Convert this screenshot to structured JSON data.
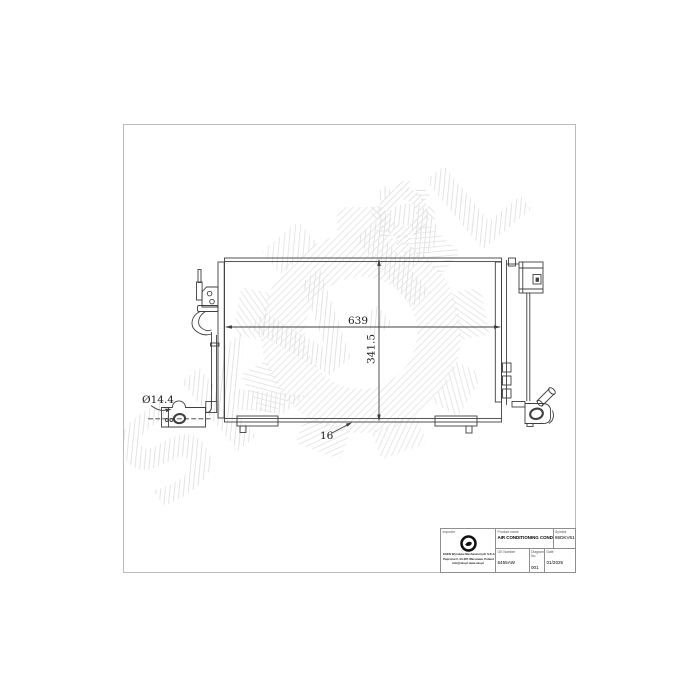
{
  "page": {
    "background": "#ffffff",
    "frame_border_color": "#bcbcbc",
    "line_color": "#3f3f3f"
  },
  "watermark": {
    "text": "SKV.PL",
    "hatch_color": "#e6e6e6"
  },
  "drawing": {
    "type": "technical-drawing",
    "subject": "air conditioning condenser outline with brackets, pipes and receiver drier",
    "dimensions": {
      "core_width": "639",
      "core_height": "341.5",
      "inlet_diameter": "Ø14.4",
      "thickness": "16"
    }
  },
  "title_block": {
    "importer": {
      "label": "Importer",
      "company_line1": "ESEN Wyrobów Mechanicznych S.K.A.",
      "company_line2": "Paprotna 2, 03-287 Warszawa, Poland",
      "company_line3": "info@skv.pl   www.skv.pl"
    },
    "product": {
      "label": "Product name",
      "value": "AIR CONDITIONING CONDENSER"
    },
    "symbol": {
      "label": "Symbol",
      "value": "86DKV61B"
    },
    "oe_number": {
      "label": "OE Number",
      "value": "6455AW"
    },
    "drawing_no": {
      "label": "Diagram No.",
      "value": "001"
    },
    "date": {
      "label": "Date",
      "value": "01/2025"
    }
  }
}
